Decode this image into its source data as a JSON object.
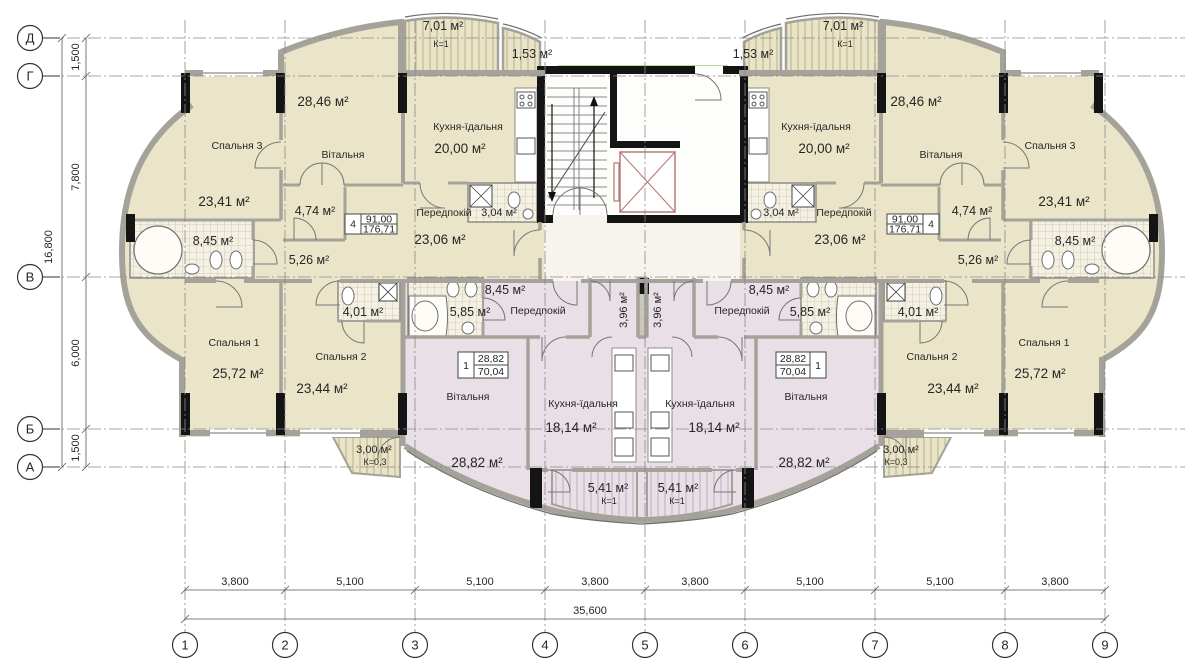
{
  "drawing": {
    "t4": {
      "unit_no": "4",
      "table_living": "91,00",
      "table_total": "176,71",
      "bedroom3_name": "Спальня 3",
      "bedroom3_area": "23,41 м²",
      "living_name": "Вітальня",
      "living_area": "28,46 м²",
      "kitchen_name": "Кухня-їдальня",
      "kitchen_area": "20,00 м²",
      "hall_name": "Передпокій",
      "hall_area": "23,06 м²",
      "wc_area": "3,04 м²",
      "bath_area": "8,45 м²",
      "corridor_area": "5,26 м²",
      "storage_area": "4,74 м²",
      "bedroom1_name": "Спальня 1",
      "bedroom1_area": "25,72 м²",
      "bedroom2_name": "Спальня 2",
      "bedroom2_area": "23,44 м²",
      "bath2_area": "4,01 м²",
      "balcony_large_area": "7,01 м²",
      "balcony_large_k": "К=1",
      "balcony_small_area": "1,53 м²",
      "balcony_rear_area": "3,00 м²",
      "balcony_rear_k": "К=0,3"
    },
    "t1": {
      "unit_no": "1",
      "table_living": "28,82",
      "table_total": "70,04",
      "living_name": "Вітальня",
      "living_area": "28,82 м²",
      "kitchen_name": "Кухня-їдальня",
      "kitchen_area": "18,14 м²",
      "hall_name": "Передпокій",
      "hall_area": "8,45 м²",
      "bath_area": "5,85 м²",
      "corridor_area": "3,96 м²",
      "balcony_area": "5,41 м²",
      "balcony_k": "К=1"
    },
    "grid": {
      "row_axes": [
        "Д",
        "Г",
        "В",
        "Б",
        "А"
      ],
      "col_axes": [
        "1",
        "2",
        "3",
        "4",
        "5",
        "6",
        "7",
        "8",
        "9"
      ],
      "row_dims": [
        "1,500",
        "7,800",
        "6,000",
        "1,500"
      ],
      "row_total": "16,800",
      "col_dims": [
        "3,800",
        "5,100",
        "5,100",
        "3,800",
        "3,800",
        "5,100",
        "5,100",
        "3,800"
      ],
      "col_total": "35,600"
    },
    "colors": {
      "apartment_beige": "#eae5c9",
      "apartment_pink": "#e8dfe7",
      "glass_green": "#72b544",
      "elevator_red": "#b5726f"
    }
  }
}
